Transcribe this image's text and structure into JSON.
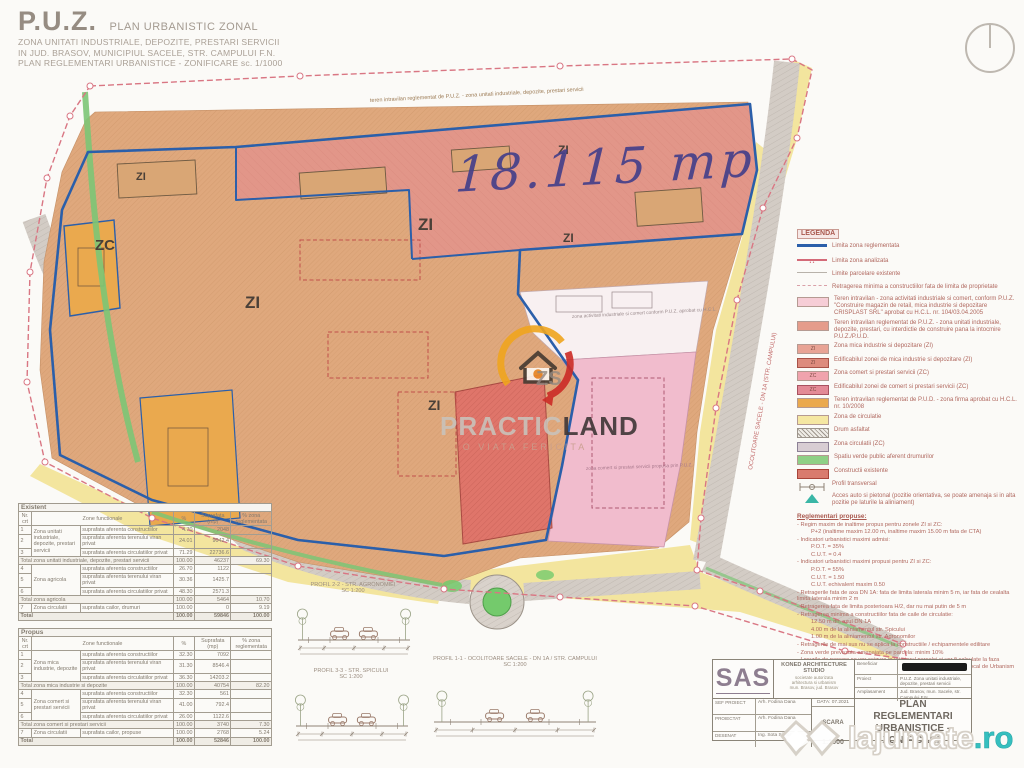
{
  "sheet": {
    "title_main": "P.U.Z.",
    "title_type": "PLAN URBANISTIC ZONAL",
    "title_lines": [
      "ZONA UNITATI INDUSTRIALE, DEPOZITE, PRESTARI SERVICII",
      "IN JUD. BRASOV, MUNICIPIUL SACELE, STR. CAMPULUI F.N.",
      "PLAN REGLEMENTARI URBANISTICE - ZONIFICARE  sc. 1/1000"
    ]
  },
  "map": {
    "handwritten_area": "18.115 mp",
    "zone_labels": [
      "ZC",
      "ZI",
      "ZI",
      "ZI",
      "ZI",
      "ZI",
      "ZI"
    ],
    "road_label": "OCOLITOARE SACELE - DN 1A (STR. CAMPULUI)",
    "band_note": "teren intravilan reglementat de P.U.Z. - zona unitati industriale, depozite, prestari servicii",
    "white_zone_note": "zona activitati industriale si comert conform P.U.Z. aprobat cu H.C.L.",
    "pink_zone_note": "zona comert si prestari servicii propusa prin P.U.Z."
  },
  "legend": {
    "title": "LEGENDA",
    "items": [
      {
        "kind": "line",
        "color": "#2b5faa",
        "w": 3,
        "label": "Limita zona reglementata"
      },
      {
        "kind": "line-marked",
        "color": "#d46a78",
        "label": "Limita zona analizata"
      },
      {
        "kind": "line",
        "color": "#b8b2aa",
        "w": 1,
        "label": "Limite parcelare existente"
      },
      {
        "kind": "line-dash",
        "color": "#d9a0a8",
        "label": "Retragerea minima a constructiilor fata de limita de proprietate"
      },
      {
        "kind": "swatch",
        "color": "#f6cdd6",
        "label": "Teren intravilan - zona activitati industriale si comert, conform P.U.Z. \"Construire magazin de retail, mica industrie si depozitare CRISPLAST SRL\" aprobat cu H.C.L. nr. 104/03.04.2005"
      },
      {
        "kind": "swatch",
        "color": "#e59c8b",
        "label": "Teren intravilan reglementat de P.U.Z. - zona unitati industriale, depozite, prestari, cu interdictie de construire pana la intocmire P.U.Z./P.U.D."
      },
      {
        "kind": "swatch",
        "color": "#e8a395",
        "text": "ZI",
        "label": "Zona mica industrie si depozitare (ZI)"
      },
      {
        "kind": "swatch",
        "color": "#dd8b7d",
        "border": "#a85248",
        "text": "ZI",
        "label": "Edificabilul zonei de mica industrie si depozitare (ZI)"
      },
      {
        "kind": "swatch",
        "color": "#f0a3ad",
        "text": "ZC",
        "label": "Zona comert si prestari servicii (ZC)"
      },
      {
        "kind": "swatch",
        "color": "#e38a96",
        "border": "#a85260",
        "text": "ZC",
        "label": "Edificabilul zonei de comert si prestari servicii (ZC)"
      },
      {
        "kind": "swatch",
        "color": "#eaa94e",
        "label": "Teren intravilan reglementat de P.U.D. - zona firma aprobat cu H.C.L. nr. 10/2008"
      },
      {
        "kind": "swatch",
        "color": "#f5e7a2",
        "label": "Zona de circulatie"
      },
      {
        "kind": "hatch",
        "label": "Drum asfaltat"
      },
      {
        "kind": "swatch",
        "color": "#d8cdd3",
        "border": "#8d8196",
        "label": "Zona circulatii (ZC)"
      },
      {
        "kind": "swatch",
        "color": "#8fd086",
        "label": "Spatiu verde public aferent drumurilor"
      },
      {
        "kind": "swatch",
        "color": "#d97b6e",
        "border": "#a8443a",
        "label": "Constructii existente"
      },
      {
        "kind": "profile",
        "label": "Profil transversal"
      },
      {
        "kind": "access",
        "label": "Acces auto si pietonal (pozitie orientativa, se poate amenaja si in alta pozitie pe laturile la aliniament)"
      }
    ],
    "notes_title": "Reglementari propuse:",
    "notes": [
      {
        "text": "Regim maxim de inaltime propus pentru zonele ZI si ZC:",
        "indent": false
      },
      {
        "text": "P+2 (inaltime maxim 12.00 m, inaltime maxim 15.00 m fata de CTA)",
        "indent": true
      },
      {
        "text": "Indicatori urbanistici maximi admisi:",
        "indent": false
      },
      {
        "text": "P.O.T. = 35%",
        "indent": true
      },
      {
        "text": "C.U.T. = 0.4",
        "indent": true
      },
      {
        "text": "Indicatori urbanistici maximi propusi pentru ZI si ZC:",
        "indent": false
      },
      {
        "text": "P.O.T. = 55%",
        "indent": true
      },
      {
        "text": "C.U.T. = 1.50",
        "indent": true
      },
      {
        "text": "C.U.T. echivalent maxim 0.50",
        "indent": true
      },
      {
        "text": "Retragerile fata de axa DN 1A: fata de limita laterala minim 5 m, iar fata de cealalta limita laterala minim 2 m",
        "indent": false
      },
      {
        "text": "Retragerea fata de limita posterioara H/2, dar nu mai putin de 5 m",
        "indent": false
      },
      {
        "text": "Retragerea minima a constructiilor fata de caile de circulatie:",
        "indent": false
      },
      {
        "text": "12.50 m din axul DN 1A",
        "indent": true
      },
      {
        "text": "4.00 m de la aliniamentul str. Spicului",
        "indent": true
      },
      {
        "text": "1.00 m de la aliniamentul str. Agronomilor",
        "indent": true
      },
      {
        "text": "Retragerile de mai sus nu se aplica la constructiile / echipamentele edilitare",
        "indent": false
      },
      {
        "text": "Zona verde prevazuta amenajata pe parcela: minim 10%",
        "indent": false
      },
      {
        "text": "Locurile de parcare se vor asigura in interiorul parcelei si vor fi calculate la faza D.T.A.C., in functie de specificul activitatii, conform Regulamentului Local de Urbanism aferent P.U.Z.",
        "indent": false
      }
    ]
  },
  "tables": {
    "existent": {
      "title": "Existent",
      "headers": [
        "Nr. crt",
        "Zone functionale",
        "%",
        "Suprafata (mp)",
        "% zona reglementata"
      ],
      "rows": [
        {
          "type": "data",
          "nr": "1",
          "group": "Zona unitati industriale, depozite, prestari servicii",
          "groupspan": 3,
          "sub": "suprafata aferenta constructiilor",
          "pct": "4.70",
          "mp": "2048",
          "zona": ""
        },
        {
          "type": "data",
          "nr": "2",
          "sub": "suprafata aferenta terenului viran privat",
          "pct": "24.01",
          "mp": "9042.4",
          "zona": ""
        },
        {
          "type": "data",
          "nr": "3",
          "sub": "suprafata aferenta circulatiilor privat",
          "pct": "71.29",
          "mp": "22736.6",
          "zona": ""
        },
        {
          "type": "total",
          "label": "Total zona unitati industriale, depozite, prestari servicii",
          "pct": "100.00",
          "mp": "46237",
          "zona": "69.30"
        },
        {
          "type": "data",
          "nr": "4",
          "group": "Zona agricola",
          "groupspan": 3,
          "sub": "suprafata aferenta constructiilor",
          "pct": "26.70",
          "mp": "1122",
          "zona": ""
        },
        {
          "type": "data",
          "nr": "5",
          "sub": "suprafata aferenta terenului viran privat",
          "pct": "30.36",
          "mp": "1425.7",
          "zona": ""
        },
        {
          "type": "data",
          "nr": "6",
          "sub": "suprafata aferenta circulatiilor privat",
          "pct": "48.30",
          "mp": "2571.3",
          "zona": ""
        },
        {
          "type": "total",
          "label": "Total zona agricola",
          "pct": "100.00",
          "mp": "5464",
          "zona": "10.70"
        },
        {
          "type": "data",
          "nr": "7",
          "group": "Zona circulatii",
          "groupspan": 1,
          "sub": "suprafata cailor, drumuri",
          "pct": "100.00",
          "mp": "0",
          "zona": "9.19"
        },
        {
          "type": "grand",
          "label": "Total",
          "pct": "100.00",
          "mp": "59846",
          "zona": "100.00"
        }
      ]
    },
    "propus": {
      "title": "Propus",
      "headers": [
        "Nr. crt",
        "Zone functionale",
        "%",
        "Suprafata (mp)",
        "% zona reglementata"
      ],
      "rows": [
        {
          "type": "data",
          "nr": "1",
          "group": "Zona mica industrie, depozite",
          "groupspan": 3,
          "sub": "suprafata aferenta constructiilor",
          "pct": "32.30",
          "mp": "7092",
          "zona": ""
        },
        {
          "type": "data",
          "nr": "2",
          "sub": "suprafata aferenta terenului viran privat",
          "pct": "31.30",
          "mp": "8546.4",
          "zona": ""
        },
        {
          "type": "data",
          "nr": "3",
          "sub": "suprafata aferenta circulatiilor privat",
          "pct": "36.30",
          "mp": "14203.2",
          "zona": ""
        },
        {
          "type": "total",
          "label": "Total zona mica industrie si depozite",
          "pct": "100.00",
          "mp": "40754",
          "zona": "82.20"
        },
        {
          "type": "data",
          "nr": "4",
          "group": "Zona comert si prestari servicii",
          "groupspan": 3,
          "sub": "suprafata aferenta constructiilor",
          "pct": "32.30",
          "mp": "561",
          "zona": ""
        },
        {
          "type": "data",
          "nr": "5",
          "sub": "suprafata aferenta terenului viran privat",
          "pct": "41.00",
          "mp": "792.4",
          "zona": ""
        },
        {
          "type": "data",
          "nr": "6",
          "sub": "suprafata aferenta circulatiilor privat",
          "pct": "26.00",
          "mp": "1122.6",
          "zona": ""
        },
        {
          "type": "total",
          "label": "Total zona comert si prestari servicii",
          "pct": "100.00",
          "mp": "3740",
          "zona": "7.30"
        },
        {
          "type": "data",
          "nr": "7",
          "group": "Zona circulatii",
          "groupspan": 1,
          "sub": "suprafata cailor, propuse",
          "pct": "100.00",
          "mp": "2768",
          "zona": "5.24"
        },
        {
          "type": "grand",
          "label": "Total",
          "pct": "100.00",
          "mp": "52846",
          "zona": "100.00"
        }
      ]
    }
  },
  "profiles": [
    {
      "label": "PROFIL 2-2 - STR. AGRONOMIEI",
      "scale": "SC 1:200"
    },
    {
      "label": "PROFIL 3-3 - STR. SPICULUI",
      "scale": "SC 1:200"
    },
    {
      "label": "PROFIL 1-1 - OCOLITOARE SACELE - DN 1A / STR. CAMPULUI",
      "scale": "SC 1:200"
    }
  ],
  "titleblock": {
    "firm_logo": "SAS",
    "firm_name": "KONED ARCHITECTURE STUDIO",
    "firm_sub": [
      "societate autorizata",
      "arhitectura si urbanism",
      "mun. Brasov, jud. Brasov"
    ],
    "roles": [
      {
        "role": "SEF PROIECT",
        "name": "Arh. Fodina Dana"
      },
      {
        "role": "PROIECTAT",
        "name": "Arh. Fodina Dana"
      },
      {
        "role": "DESENAT",
        "name": "Ing. Sota Simona"
      }
    ],
    "date_label": "DATA: 07.2021",
    "scale_label": "SCARA",
    "scale_value": "1:1000",
    "beneficiary_label": "Beneficiar",
    "project_label": "Proiect",
    "project_value": "P.U.Z. Zona unitati industriale, depozite, prestari servicii",
    "location_label": "Amplasament",
    "location_value": "Jud. Brasov, mun. Sacele, str. Campului F.N.",
    "sheet_title": "PLAN REGLEMENTARI URBANISTICE - ZONIFICARE"
  },
  "watermarks": {
    "practicland": {
      "brand_light": "PRACTIC",
      "brand_dark": "LAND",
      "tagline": "O VIATA FERICITA",
      "mark": "ZS"
    },
    "lajumate": {
      "name": "lajumate",
      "tld": ".ro"
    }
  },
  "colors": {
    "boundary_blue": "#2b5faa",
    "boundary_pink": "#d97683",
    "parcel_tan": "#dfa87d",
    "band_salmon": "#e2958a",
    "zone_pink": "#f1bccd",
    "orange": "#eaa94e",
    "yellow": "#f3e59e",
    "green": "#7cc576",
    "road_gray": "#d3ccc5",
    "red_building": "#df756a"
  }
}
